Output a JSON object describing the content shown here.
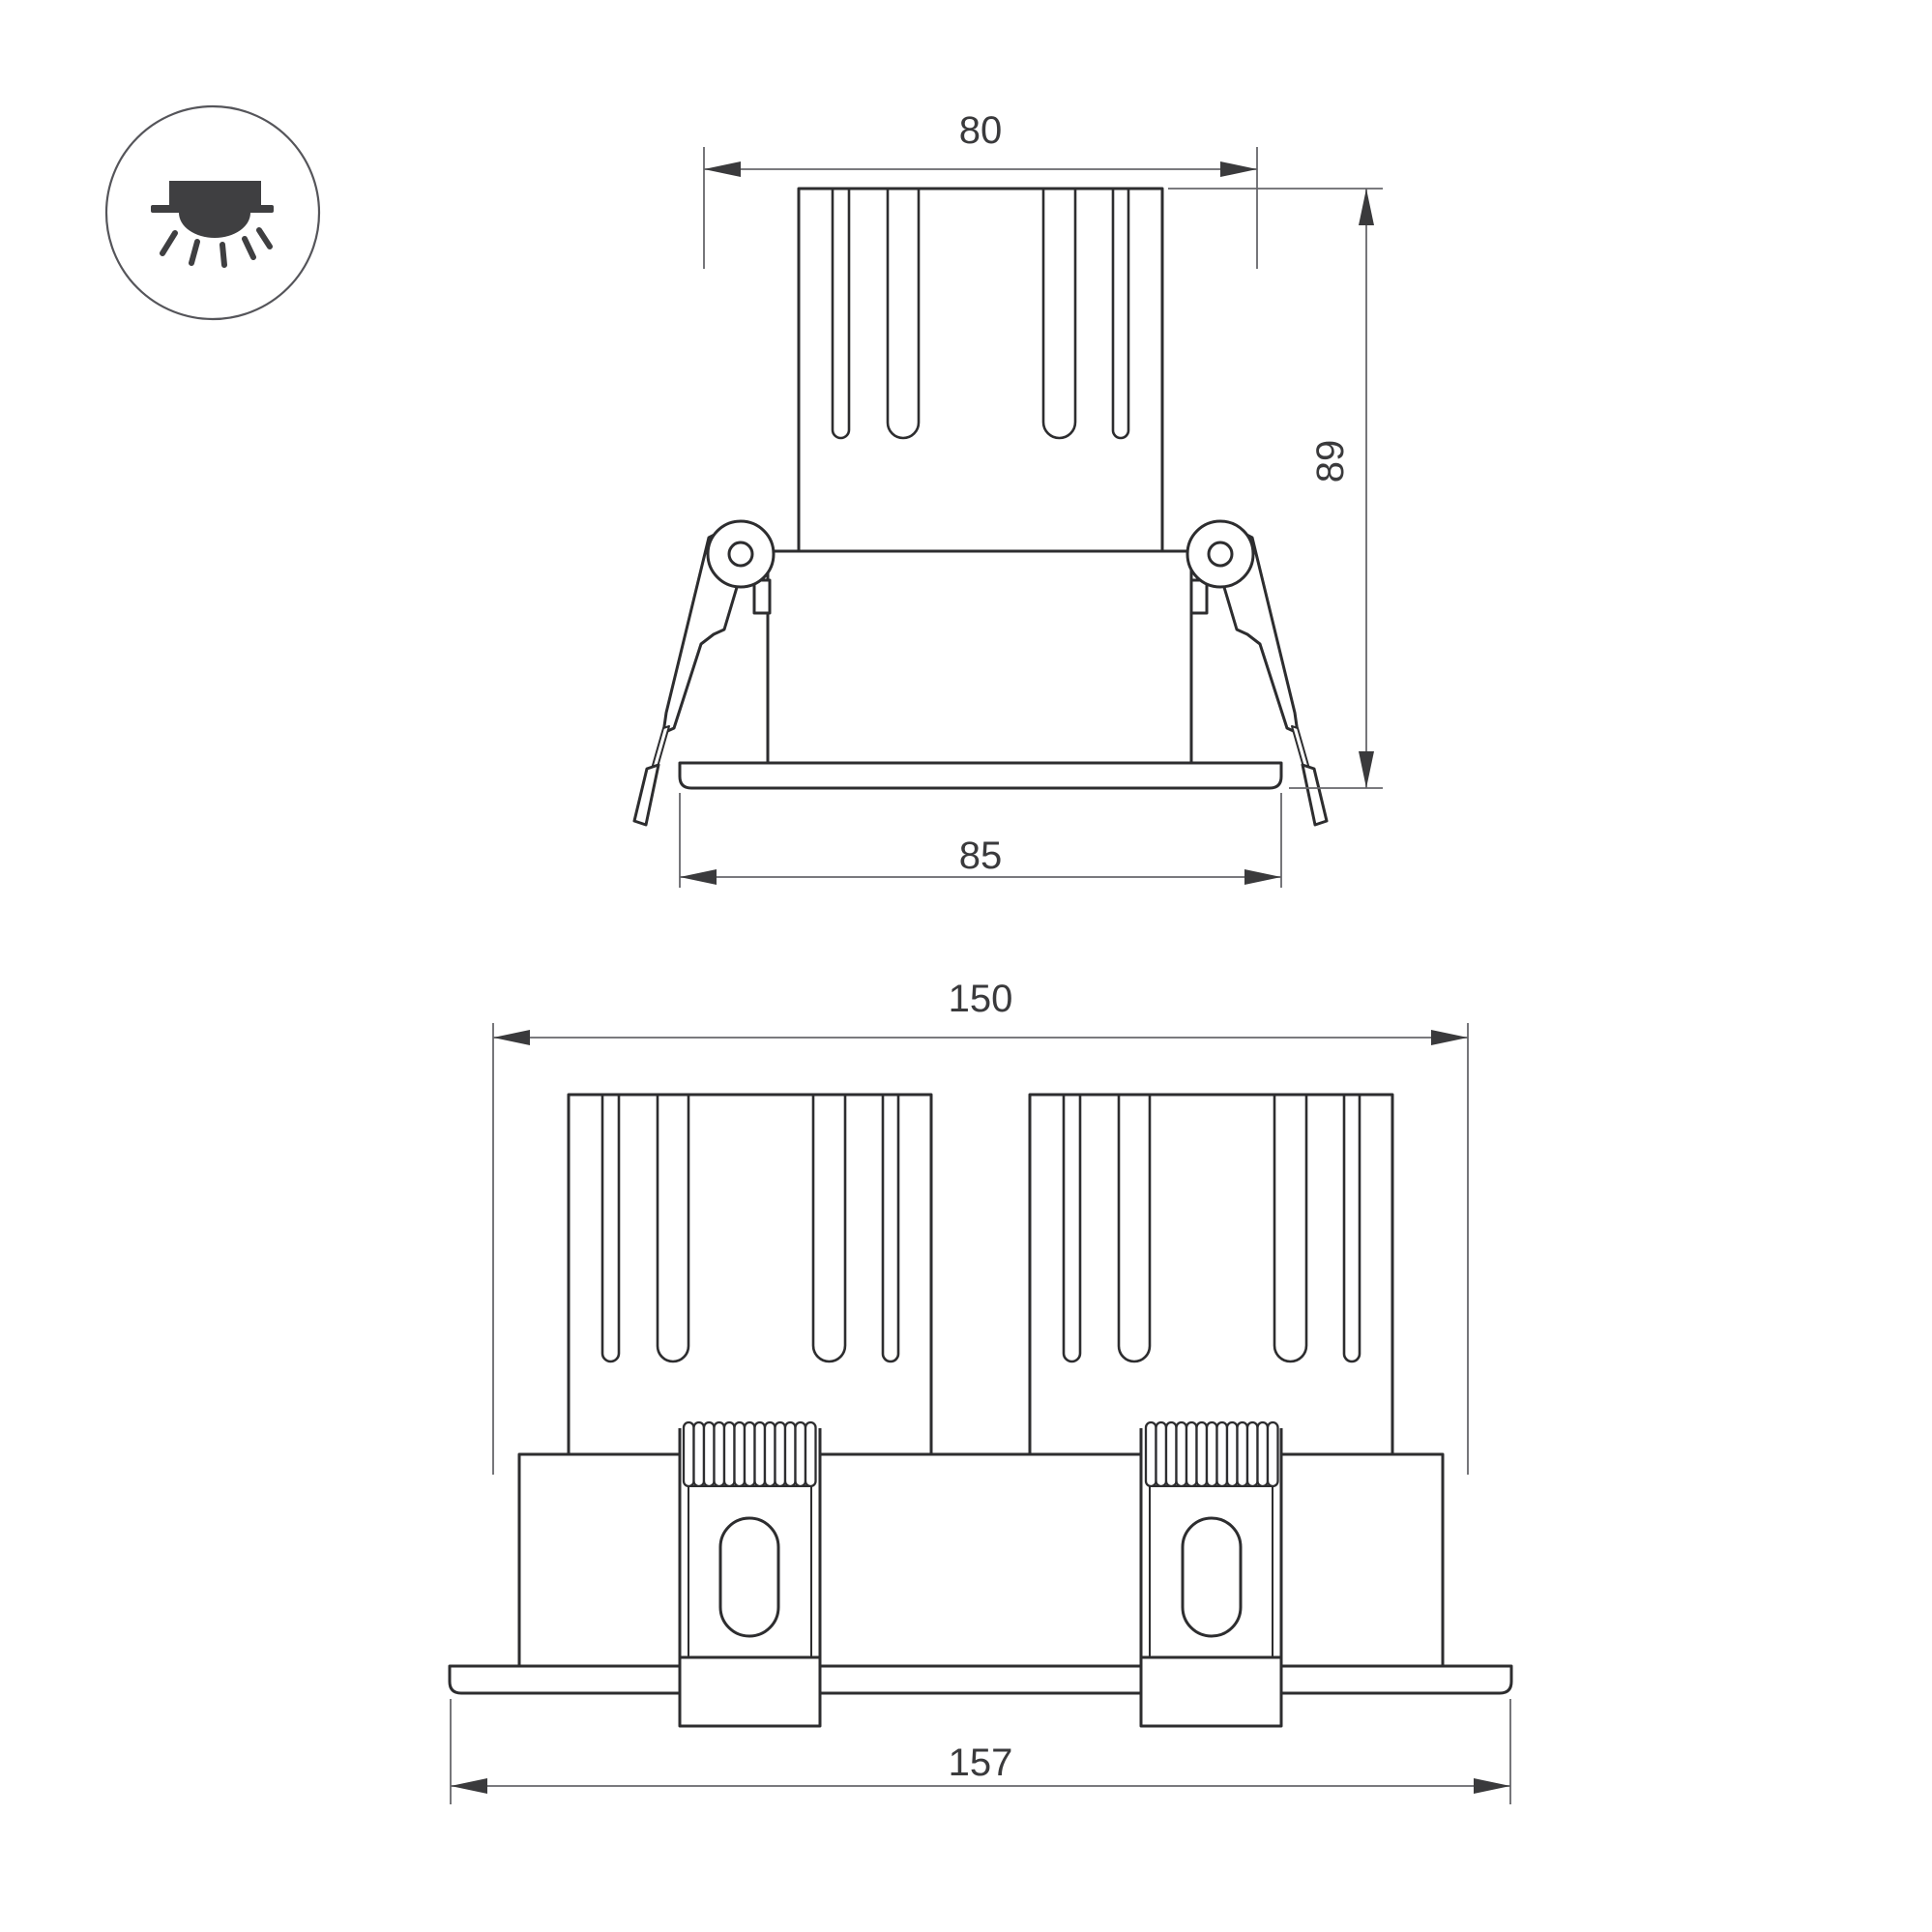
{
  "colors": {
    "background": "#ffffff",
    "outline": "#2d2d2f",
    "dimension_lines": "#67676b",
    "dimension_text": "#3a3a3c",
    "icon": "#3f3f41"
  },
  "icon": {
    "name": "recessed-downlight-mounting-icon"
  },
  "views": {
    "front_single": {
      "label": "single-head front view",
      "dimensions": {
        "cutout_width": "80",
        "height": "89",
        "flange_width": "85"
      }
    },
    "front_double": {
      "label": "twin-head front view",
      "dimensions": {
        "body_length": "150",
        "flange_length": "157"
      }
    }
  }
}
